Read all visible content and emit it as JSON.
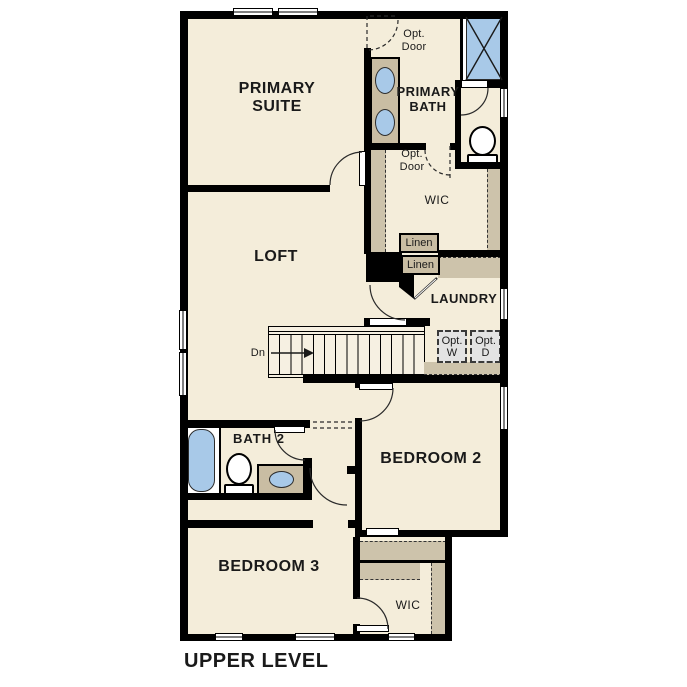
{
  "title": "UPPER LEVEL",
  "rooms": {
    "primary_suite": "PRIMARY SUITE",
    "primary_bath": "PRIMARY BATH",
    "wic_upper": "WIC",
    "laundry": "LAUNDRY",
    "loft": "LOFT",
    "bath_2": "BATH 2",
    "bedroom_2": "BEDROOM 2",
    "bedroom_3": "BEDROOM 3",
    "wic_lower": "WIC"
  },
  "features": {
    "opt_door_upper": "Opt. Door",
    "opt_door_lower": "Opt. Door",
    "linen_1": "Linen",
    "linen_2": "Linen",
    "opt_washer": "Opt. W",
    "opt_dryer": "Opt. D",
    "stairs_direction": "Dn"
  },
  "colors": {
    "floor": "#f4edda",
    "wall": "#000000",
    "cabinet_tan": "#c9bda3",
    "fixture_blue": "#a8c9e8",
    "optional_appliance_gray": "#e3e3e3"
  }
}
